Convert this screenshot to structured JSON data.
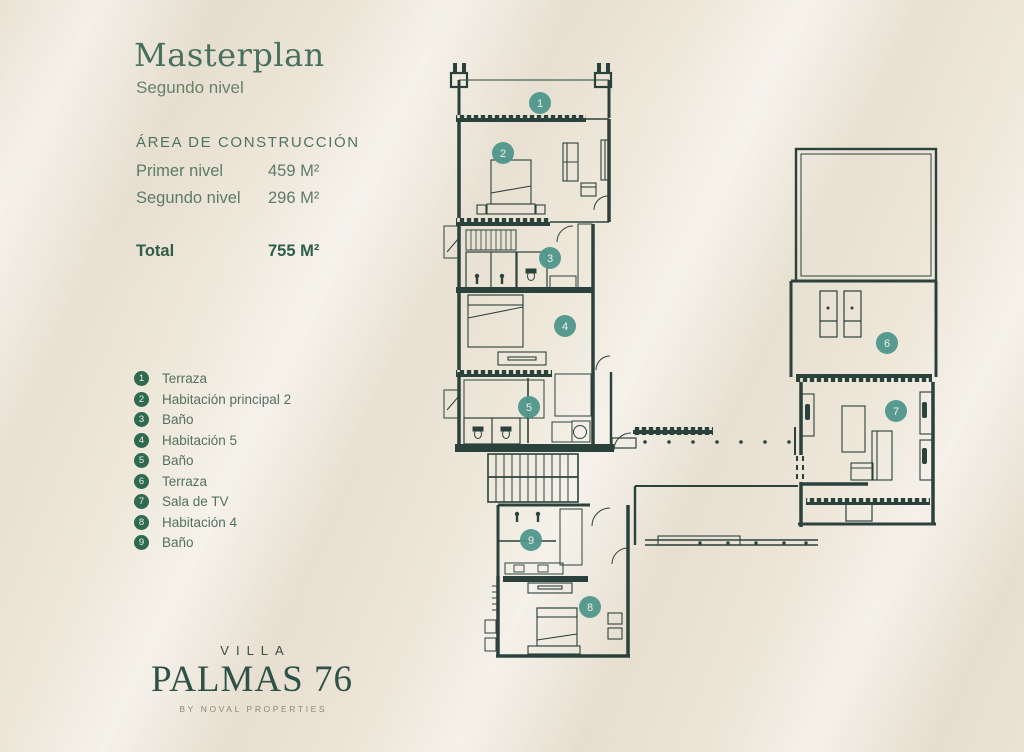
{
  "masthead": {
    "title": "Masterplan",
    "subtitle": "Segundo nivel"
  },
  "construction_area": {
    "heading": "ÁREA DE CONSTRUCCIÓN",
    "rows": [
      {
        "label": "Primer nivel",
        "value": "459 M²"
      },
      {
        "label": "Segundo nivel",
        "value": "296 M²"
      }
    ],
    "total_row": {
      "label": "Total",
      "value": "755 M²"
    }
  },
  "legend": {
    "badge_color": "#2e6a52",
    "items": [
      {
        "n": "1",
        "label": "Terraza"
      },
      {
        "n": "2",
        "label": "Habitación principal 2"
      },
      {
        "n": "3",
        "label": "Baño"
      },
      {
        "n": "4",
        "label": "Habitación 5"
      },
      {
        "n": "5",
        "label": "Baño"
      },
      {
        "n": "6",
        "label": "Terraza"
      },
      {
        "n": "7",
        "label": "Sala de TV"
      },
      {
        "n": "8",
        "label": "Habitación 4"
      },
      {
        "n": "9",
        "label": "Baño"
      }
    ]
  },
  "floorplan": {
    "line_color": "#2b423c",
    "marker_color": "#4f968b",
    "markers": [
      {
        "n": "1",
        "label": "Terraza",
        "x": 540,
        "y": 103
      },
      {
        "n": "2",
        "label": "Habitación principal 2",
        "x": 503,
        "y": 153
      },
      {
        "n": "3",
        "label": "Baño",
        "x": 550,
        "y": 258
      },
      {
        "n": "4",
        "label": "Habitación 5",
        "x": 565,
        "y": 326
      },
      {
        "n": "5",
        "label": "Baño",
        "x": 529,
        "y": 407
      },
      {
        "n": "6",
        "label": "Terraza",
        "x": 887,
        "y": 343
      },
      {
        "n": "7",
        "label": "Sala de TV",
        "x": 896,
        "y": 411
      },
      {
        "n": "8",
        "label": "Habitación 4",
        "x": 590,
        "y": 607
      },
      {
        "n": "9",
        "label": "Baño",
        "x": 531,
        "y": 540
      }
    ]
  },
  "brand": {
    "villa": "VILLA",
    "name": "PALMAS 76",
    "byline": "BY NOVAL PROPERTIES"
  },
  "colors": {
    "background": "#efe9dc",
    "title_green": "#47705f",
    "body_green": "#5d7a6b",
    "total_green": "#2f5d4a"
  }
}
